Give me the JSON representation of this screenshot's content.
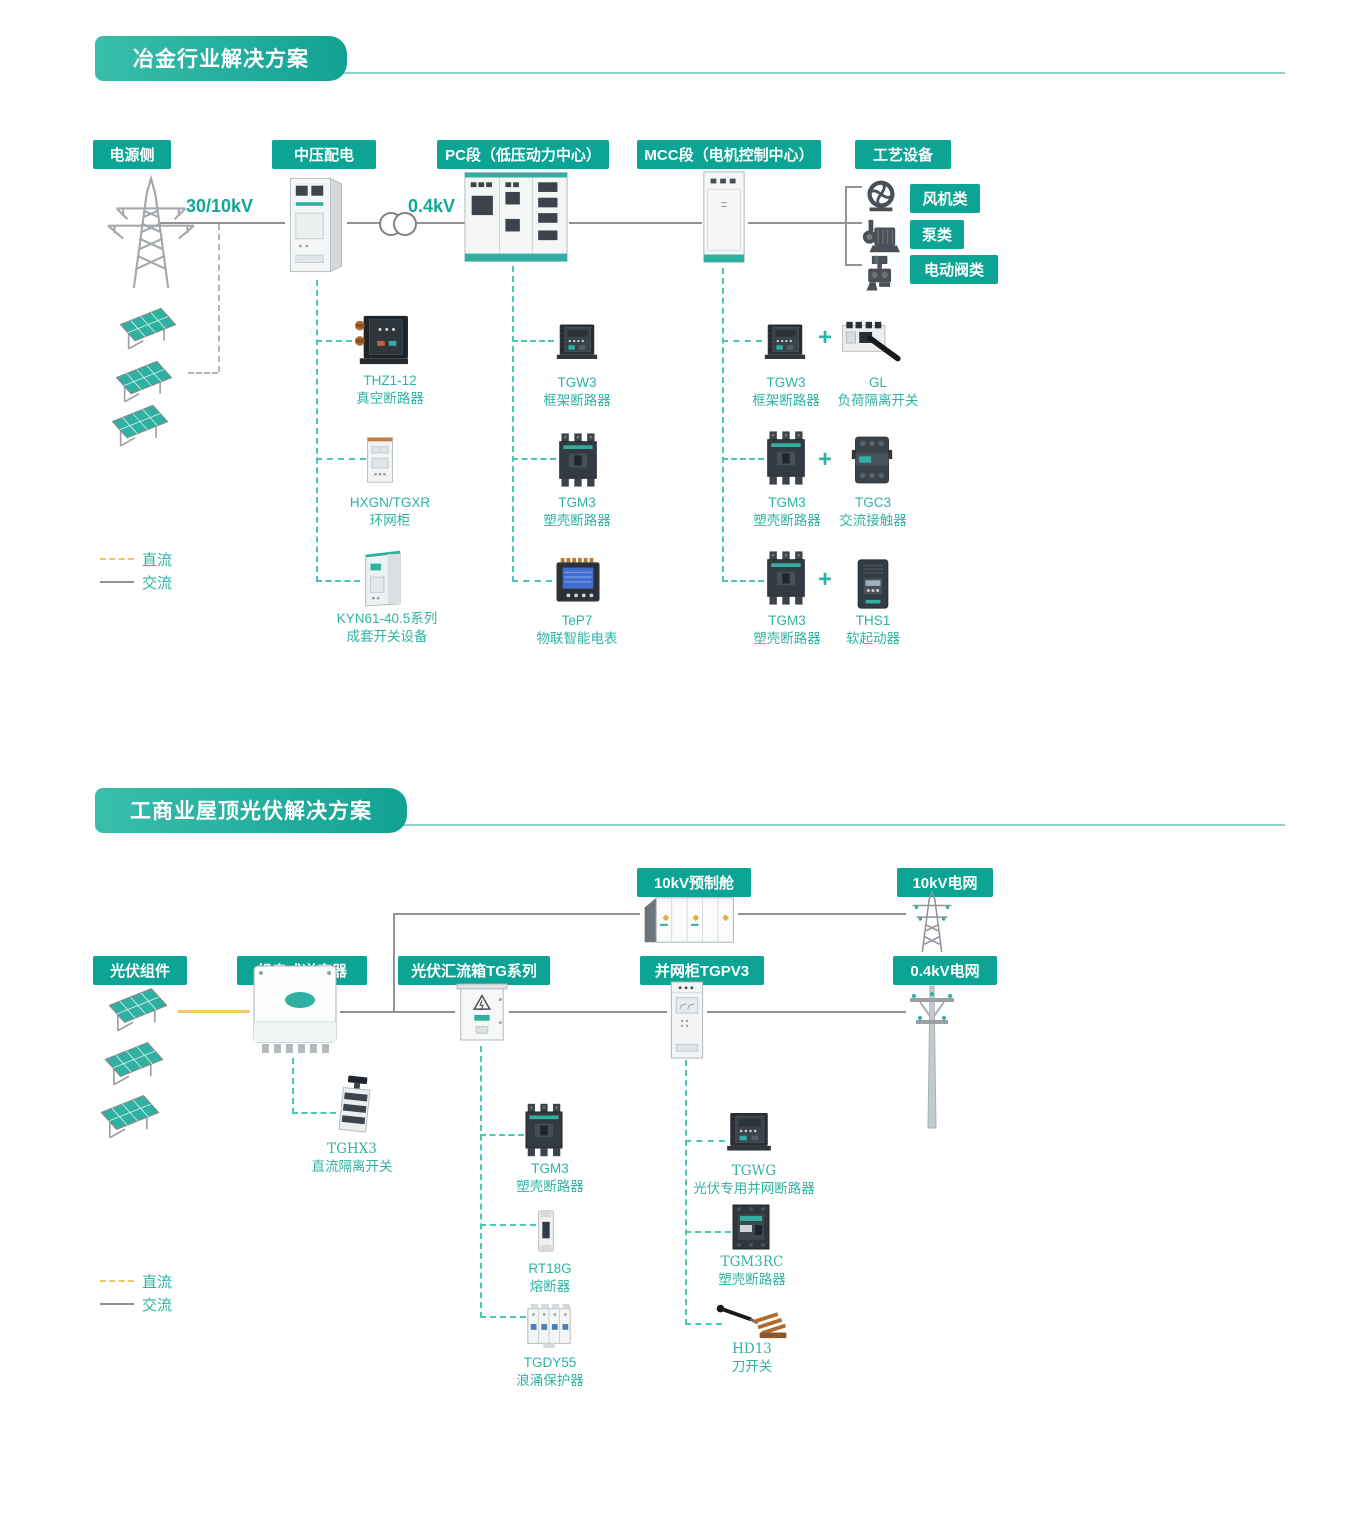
{
  "plus": "+",
  "s1": {
    "title": "冶金行业解决方案",
    "headers": {
      "power": "电源侧",
      "mv": "中压配电",
      "pc": "PC段（低压动力中心）",
      "mcc": "MCC段（电机控制中心）",
      "process": "工艺设备"
    },
    "voltage_hv": "30/10kV",
    "voltage_lv": "0.4kV",
    "loads": {
      "fan": "风机类",
      "pump": "泵类",
      "valve": "电动阀类"
    },
    "mv_devices": [
      {
        "model": "THZ1-12",
        "name": "真空断路器"
      },
      {
        "model": "HXGN/TGXR",
        "name": "环网柜"
      },
      {
        "model": "KYN61-40.5系列",
        "name": "成套开关设备"
      }
    ],
    "pc_devices": [
      {
        "model": "TGW3",
        "name": "框架断路器"
      },
      {
        "model": "TGM3",
        "name": "塑壳断路器"
      },
      {
        "model": "TeP7",
        "name": "物联智能电表"
      }
    ],
    "mcc_rows": [
      {
        "a": {
          "model": "TGW3",
          "name": "框架断路器"
        },
        "b": {
          "model": "GL",
          "name": "负荷隔离开关"
        }
      },
      {
        "a": {
          "model": "TGM3",
          "name": "塑壳断路器"
        },
        "b": {
          "model": "TGC3",
          "name": "交流接触器"
        }
      },
      {
        "a": {
          "model": "TGM3",
          "name": "塑壳断路器"
        },
        "b": {
          "model": "THS1",
          "name": "软起动器"
        }
      }
    ],
    "legend": {
      "dc": "直流",
      "ac": "交流"
    }
  },
  "s2": {
    "title": "工商业屋顶光伏解决方案",
    "headers": {
      "pv": "光伏组件",
      "inverter": "组串式逆变器",
      "combiner": "光伏汇流箱TG系列",
      "grid_cabinet": "并网柜TGPV3",
      "cabin": "10kV预制舱",
      "grid10": "10kV电网",
      "grid04": "0.4kV电网"
    },
    "inverter_device": {
      "model": "TGHX3",
      "name": "直流隔离开关"
    },
    "combiner_devices": [
      {
        "model": "TGM3",
        "name": "塑壳断路器"
      },
      {
        "model": "RT18G",
        "name": "熔断器"
      },
      {
        "model": "TGDY55",
        "name": "浪涌保护器"
      }
    ],
    "grid_devices": [
      {
        "model": "TGWG",
        "name": "光伏专用并网断路器"
      },
      {
        "model": "TGM3RC",
        "name": "塑壳断路器"
      },
      {
        "model": "HD13",
        "name": "刀开关"
      }
    ],
    "legend": {
      "dc": "直流",
      "ac": "交流"
    }
  }
}
